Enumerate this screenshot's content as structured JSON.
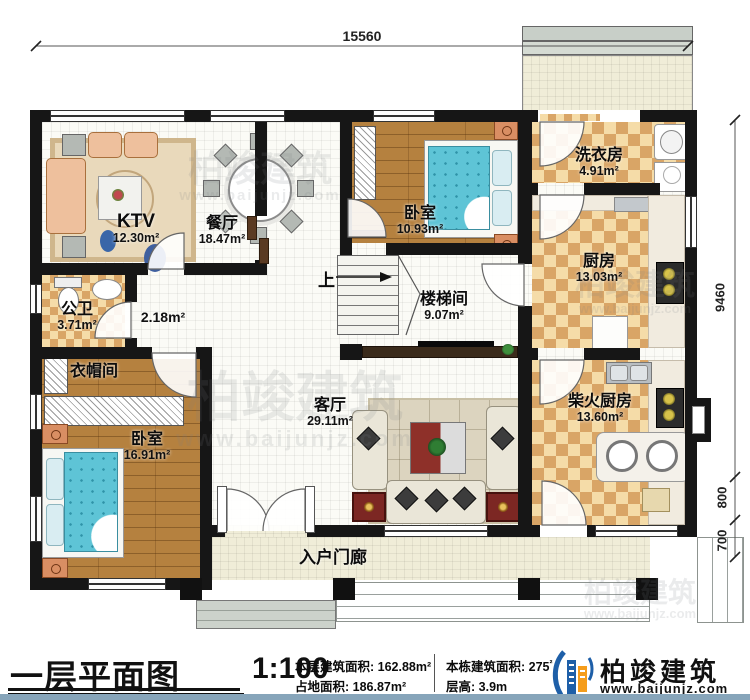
{
  "dimensions": {
    "width_total": "15560",
    "height_main": "9460",
    "height_step_upper": "800",
    "height_step_lower": "700"
  },
  "rooms": {
    "ktv": {
      "name": "KTV",
      "area": "12.30m²"
    },
    "dining": {
      "name": "餐厅",
      "area": "18.47m²"
    },
    "bedroom1": {
      "name": "卧室",
      "area": "10.93m²"
    },
    "laundry": {
      "name": "洗衣房",
      "area": "4.91m²"
    },
    "kitchen": {
      "name": "厨房",
      "area": "13.03m²"
    },
    "stairwell": {
      "name": "楼梯间",
      "area": "9.07m²"
    },
    "hallway": {
      "area": "2.18m²"
    },
    "bathroom": {
      "name": "公卫",
      "area": "3.71m²"
    },
    "cloakroom": {
      "name": "衣帽间"
    },
    "bedroom2": {
      "name": "卧室",
      "area": "16.91m²"
    },
    "living": {
      "name": "客厅",
      "area": "29.11m²"
    },
    "firewood_kitchen": {
      "name": "柴火厨房",
      "area": "13.60m²"
    },
    "porch": {
      "name": "入户门廊"
    }
  },
  "stairs": {
    "up_label": "上"
  },
  "titlebar": {
    "plan_name": "一层平面图",
    "scale": "1:100",
    "stats": {
      "floor_area_label": "本层建筑面积:",
      "floor_area": "162.88m²",
      "land_area_label": "占地面积:",
      "land_area": "186.87m²",
      "total_area_label": "本栋建筑面积:",
      "total_area": "275",
      "total_area_sup": "²",
      "height_label": "层高:",
      "height": "3.9m"
    },
    "brand": {
      "name": "柏竣建筑",
      "site": "www.baijunjz.com"
    }
  },
  "watermark": {
    "name": "柏竣建筑",
    "site": "www.baijunjz.com"
  }
}
